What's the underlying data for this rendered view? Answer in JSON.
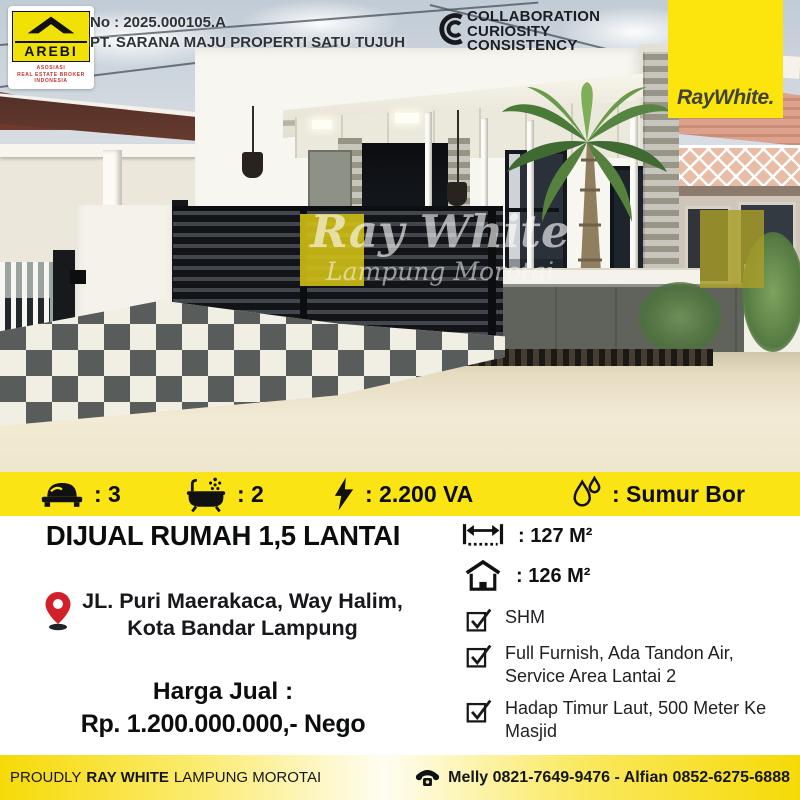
{
  "header": {
    "listing_no": "No : 2025.000105.A",
    "company": "PT. SARANA MAJU PROPERTI SATU TUJUH",
    "arebi": {
      "name": "AREBI",
      "line1": "ASOSIASI",
      "line2": "REAL ESTATE BROKER",
      "line3": "INDONESIA"
    },
    "values_logo": {
      "line1": "COLLABORATION",
      "line2": "CURIOSITY",
      "line3": "CONSISTENCY"
    },
    "brand": "RayWhite."
  },
  "photo": {
    "watermark_line1": "Ray White",
    "watermark_line2": "Lampung Morotai"
  },
  "features": [
    {
      "icon": "bed-icon",
      "label": ": 3"
    },
    {
      "icon": "bath-icon",
      "label": ": 2"
    },
    {
      "icon": "bolt-icon",
      "label": ": 2.200 VA"
    },
    {
      "icon": "water-icon",
      "label": ": Sumur Bor"
    }
  ],
  "listing": {
    "title": "DIJUAL RUMAH 1,5 LANTAI",
    "address_line1": "JL. Puri Maerakaca, Way Halim,",
    "address_line2": "Kota Bandar Lampung",
    "price_label": "Harga Jual :",
    "price_value": "Rp. 1.200.000.000,- Nego",
    "land_area": ": 127 M²",
    "building_area": ": 126 M²",
    "checklist": [
      "SHM",
      "Full Furnish, Ada Tandon Air, Service Area Lantai 2",
      "Hadap Timur Laut, 500 Meter Ke Masjid"
    ]
  },
  "footer": {
    "proudly": "PROUDLY",
    "brand": "RAY WHITE",
    "office": "LAMPUNG MOROTAI",
    "contacts": "Melly 0821-7649-9476 - Alfian 0852-6275-6888"
  },
  "colors": {
    "brand_yellow": "#FAE414",
    "pin_red": "#D2202A",
    "text_black": "#111111"
  }
}
